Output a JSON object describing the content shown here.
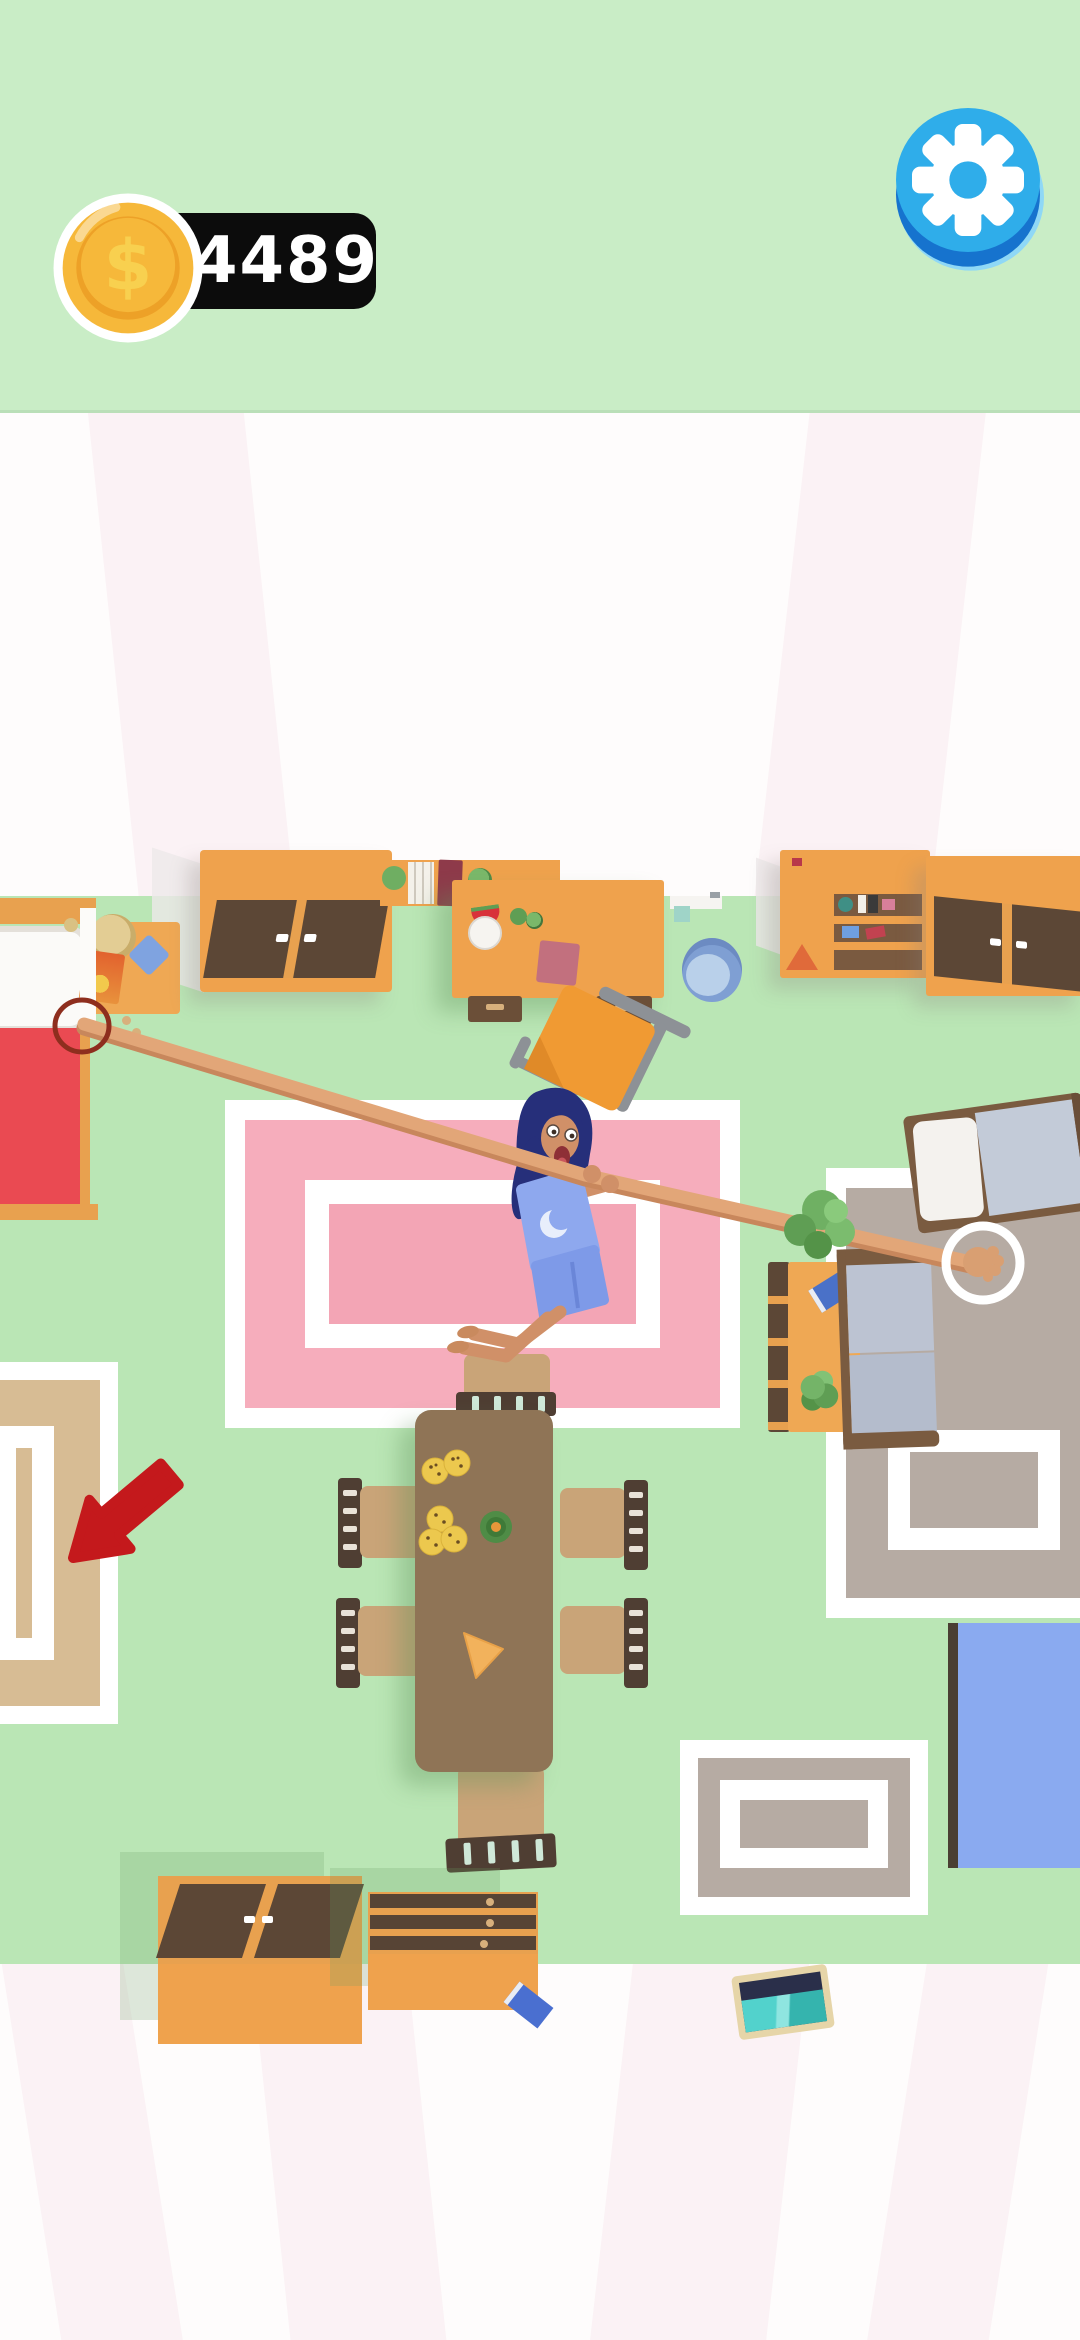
{
  "hud": {
    "coins": "4489",
    "coin_icon": "dollar-coin-icon",
    "settings_icon": "gear-icon"
  },
  "palette": {
    "header_bg": "#c9edc6",
    "floor_green": "#bae6b5",
    "wall_white": "#ffffff",
    "stripe_pink": "#f7e9ee",
    "badge_bg": "#0c0c0c",
    "badge_text": "#ffffff",
    "coin_gold": "#f6b83a",
    "settings_blue": "#2fadea",
    "rope_tan": "#e2a678",
    "arrow_red": "#c4191c",
    "rug_pink": "#f6adbc",
    "rug_tan": "#d7bc94",
    "rug_taupe": "#b6aba3",
    "rug_blue": "#8aaaf0",
    "furniture_orange": "#efa24d",
    "door_brown": "#5c4736",
    "table_brown": "#8f7456",
    "bed_red": "#ea4a52",
    "bucket_blue": "#7f9fd3",
    "character_hair": "#262f7a",
    "character_outfit": "#8ea8ee"
  },
  "scene": {
    "character": "woman-lying-on-rug",
    "rope": "rope-to-hand",
    "hint_arrow": "red-arrow-pointing-at-rug"
  }
}
